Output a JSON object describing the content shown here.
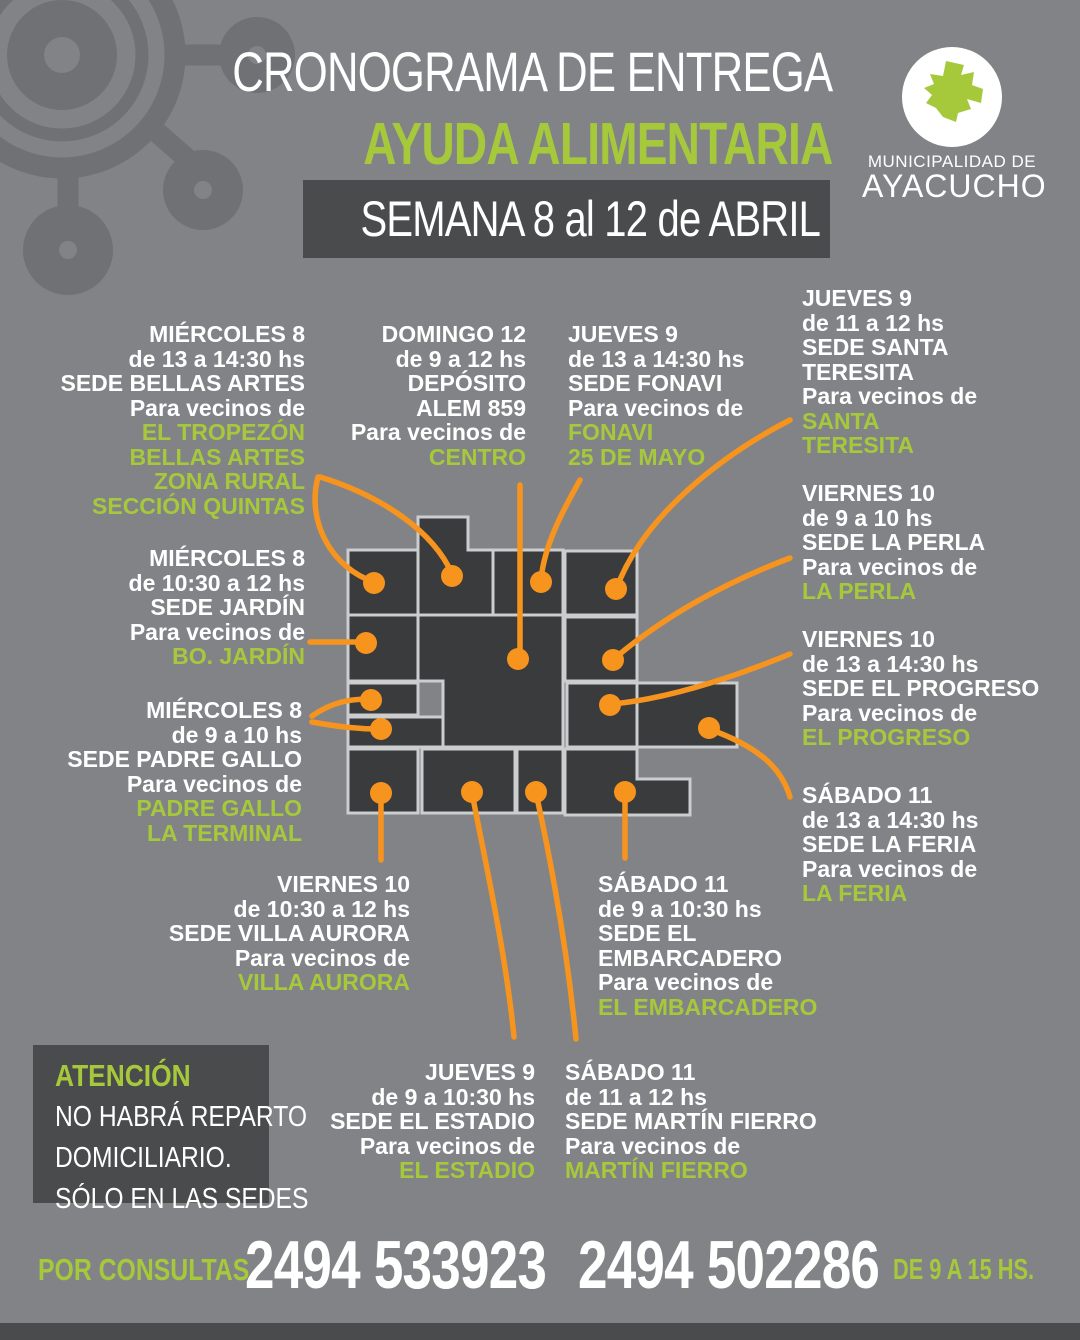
{
  "header": {
    "title_line1": "CRONOGRAMA DE ENTREGA",
    "title_line2": "AYUDA ALIMENTARIA",
    "week_banner": "SEMANA 8 al 12 de ABRIL"
  },
  "logo": {
    "org_line1": "MUNICIPALIDAD DE",
    "org_line2": "AYACUCHO"
  },
  "schedule": [
    {
      "id": "bellas-artes",
      "day": "MIÉRCOLES 8",
      "time": "de 13 a 14:30 hs",
      "place": [
        "SEDE BELLAS ARTES"
      ],
      "intro": "Para vecinos de",
      "zones": [
        "EL TROPEZÓN",
        "BELLAS ARTES",
        "ZONA RURAL",
        "SECCIÓN QUINTAS"
      ]
    },
    {
      "id": "jardin",
      "day": "MIÉRCOLES 8",
      "time": "de 10:30 a 12 hs",
      "place": [
        "SEDE JARDÍN"
      ],
      "intro": "Para vecinos de",
      "zones": [
        "BO. JARDÍN"
      ]
    },
    {
      "id": "padre-gallo",
      "day": "MIÉRCOLES 8",
      "time": "de 9 a 10 hs",
      "place": [
        "SEDE PADRE GALLO"
      ],
      "intro": "Para vecinos de",
      "zones": [
        "PADRE GALLO",
        "LA TERMINAL"
      ]
    },
    {
      "id": "centro",
      "day": "DOMINGO 12",
      "time": "de 9 a 12 hs",
      "place": [
        "DEPÓSITO",
        "ALEM 859"
      ],
      "intro": "Para vecinos de",
      "zones": [
        "CENTRO"
      ]
    },
    {
      "id": "fonavi",
      "day": "JUEVES 9",
      "time": "de 13 a 14:30 hs",
      "place": [
        "SEDE FONAVI"
      ],
      "intro": "Para vecinos de",
      "zones": [
        "FONAVI",
        "25 DE MAYO"
      ]
    },
    {
      "id": "santa-teresita",
      "day": "JUEVES 9",
      "time": "de 11 a 12 hs",
      "place": [
        "SEDE SANTA",
        "TERESITA"
      ],
      "intro": "Para vecinos de",
      "zones": [
        "SANTA",
        "TERESITA"
      ]
    },
    {
      "id": "la-perla",
      "day": "VIERNES 10",
      "time": "de 9 a 10 hs",
      "place": [
        "SEDE LA PERLA"
      ],
      "intro": "Para vecinos de",
      "zones": [
        "LA PERLA"
      ]
    },
    {
      "id": "el-progreso",
      "day": "VIERNES 10",
      "time": "de 13 a 14:30 hs",
      "place": [
        "SEDE EL PROGRESO"
      ],
      "intro": "Para vecinos de",
      "zones": [
        "EL PROGRESO"
      ]
    },
    {
      "id": "la-feria",
      "day": "SÁBADO 11",
      "time": "de 13 a 14:30 hs",
      "place": [
        "SEDE LA FERIA"
      ],
      "intro": "Para vecinos de",
      "zones": [
        "LA FERIA"
      ]
    },
    {
      "id": "villa-aurora",
      "day": "VIERNES 10",
      "time": "de 10:30 a 12 hs",
      "place": [
        "SEDE VILLA AURORA"
      ],
      "intro": "Para vecinos de",
      "zones": [
        "VILLA AURORA"
      ]
    },
    {
      "id": "embarcadero",
      "day": "SÁBADO 11",
      "time": "de 9 a 10:30 hs",
      "place": [
        "SEDE EL",
        "EMBARCADERO"
      ],
      "intro": "Para vecinos de",
      "zones": [
        "EL EMBARCADERO"
      ]
    },
    {
      "id": "estadio",
      "day": "JUEVES 9",
      "time": "de 9 a 10:30 hs",
      "place": [
        "SEDE EL ESTADIO"
      ],
      "intro": "Para vecinos de",
      "zones": [
        "EL ESTADIO"
      ]
    },
    {
      "id": "martin-fierro",
      "day": "SÁBADO 11",
      "time": "de 11 a 12 hs",
      "place": [
        "SEDE MARTÍN FIERRO"
      ],
      "intro": "Para vecinos de",
      "zones": [
        "MARTÍN FIERRO"
      ]
    }
  ],
  "attention": {
    "title": "ATENCIÓN",
    "lines": [
      "NO HABRÁ REPARTO",
      "DOMICILIARIO.",
      "SÓLO EN LAS SEDES"
    ]
  },
  "footer": {
    "label": "POR CONSULTAS",
    "phone1": "2494 533923",
    "phone2": "2494 502286",
    "hours": "DE 9 A 15 HS."
  },
  "colors": {
    "background": "#828387",
    "panel_dark": "#4a4b4d",
    "map_zone": "#3a3b3d",
    "map_border": "#cccdcf",
    "accent_green": "#a6c93b",
    "accent_orange": "#f7941e",
    "text_white": "#ffffff",
    "watermark": "#707174"
  }
}
